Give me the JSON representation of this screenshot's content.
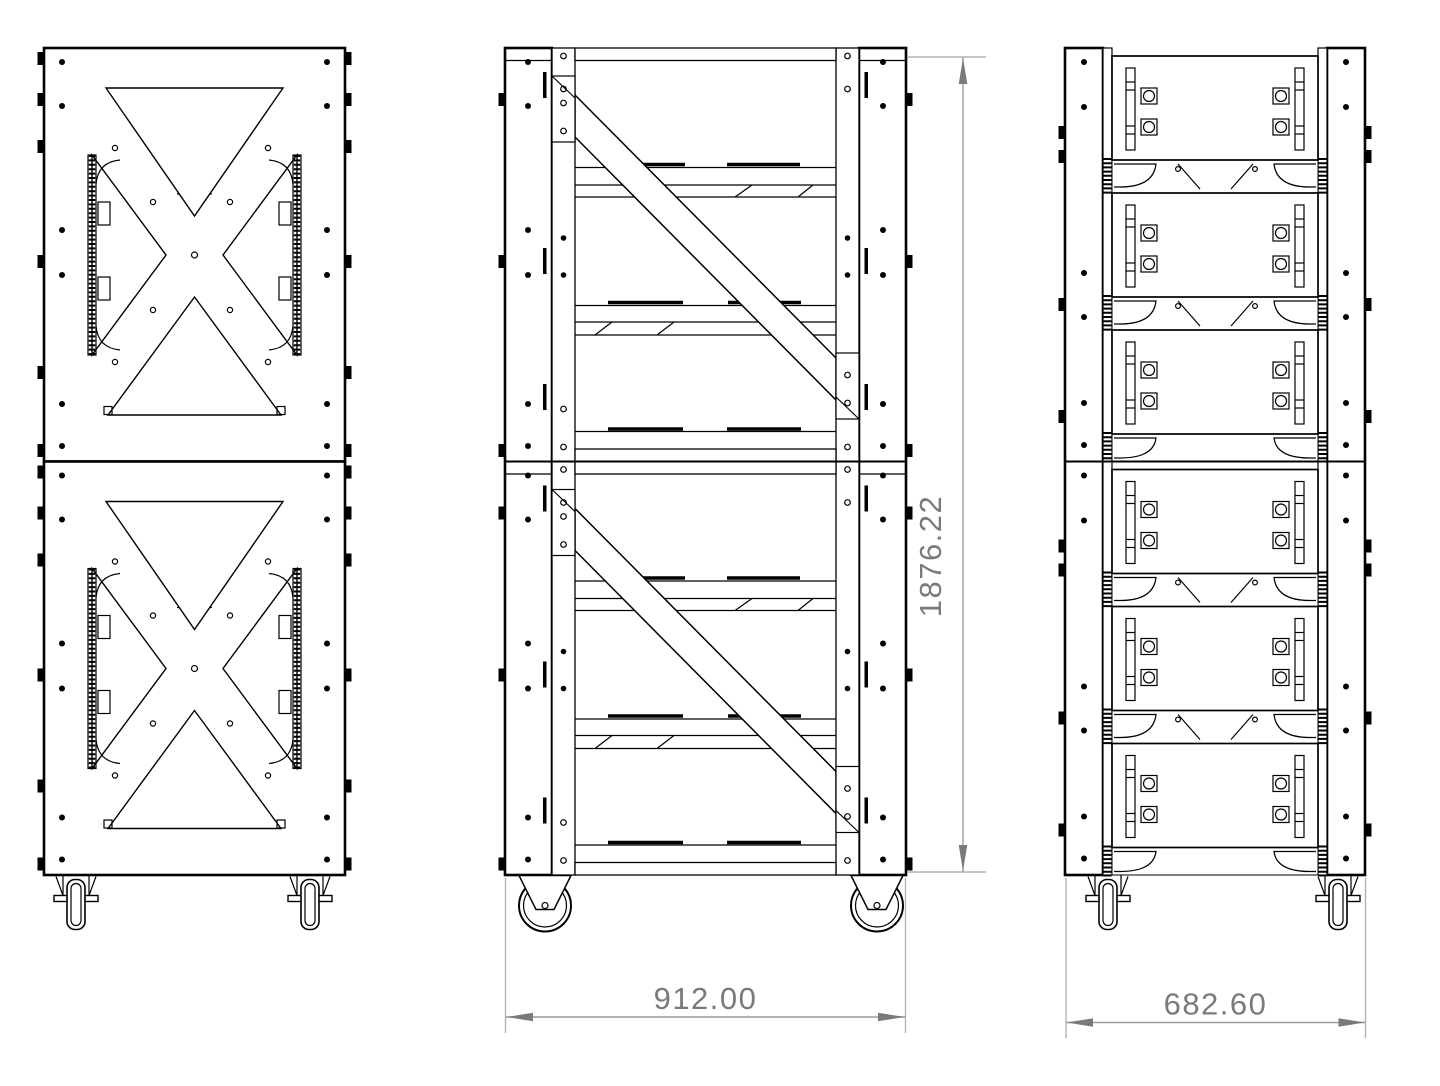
{
  "drawing": {
    "dimension_labels": {
      "overall_height": "1876.22",
      "front_width": "912.00",
      "side_width": "682.60"
    },
    "colors": {
      "line": "#000000",
      "dimension_line": "#9c9c9c",
      "dimension_text": "#7a7a7a",
      "background": "#ffffff"
    }
  }
}
